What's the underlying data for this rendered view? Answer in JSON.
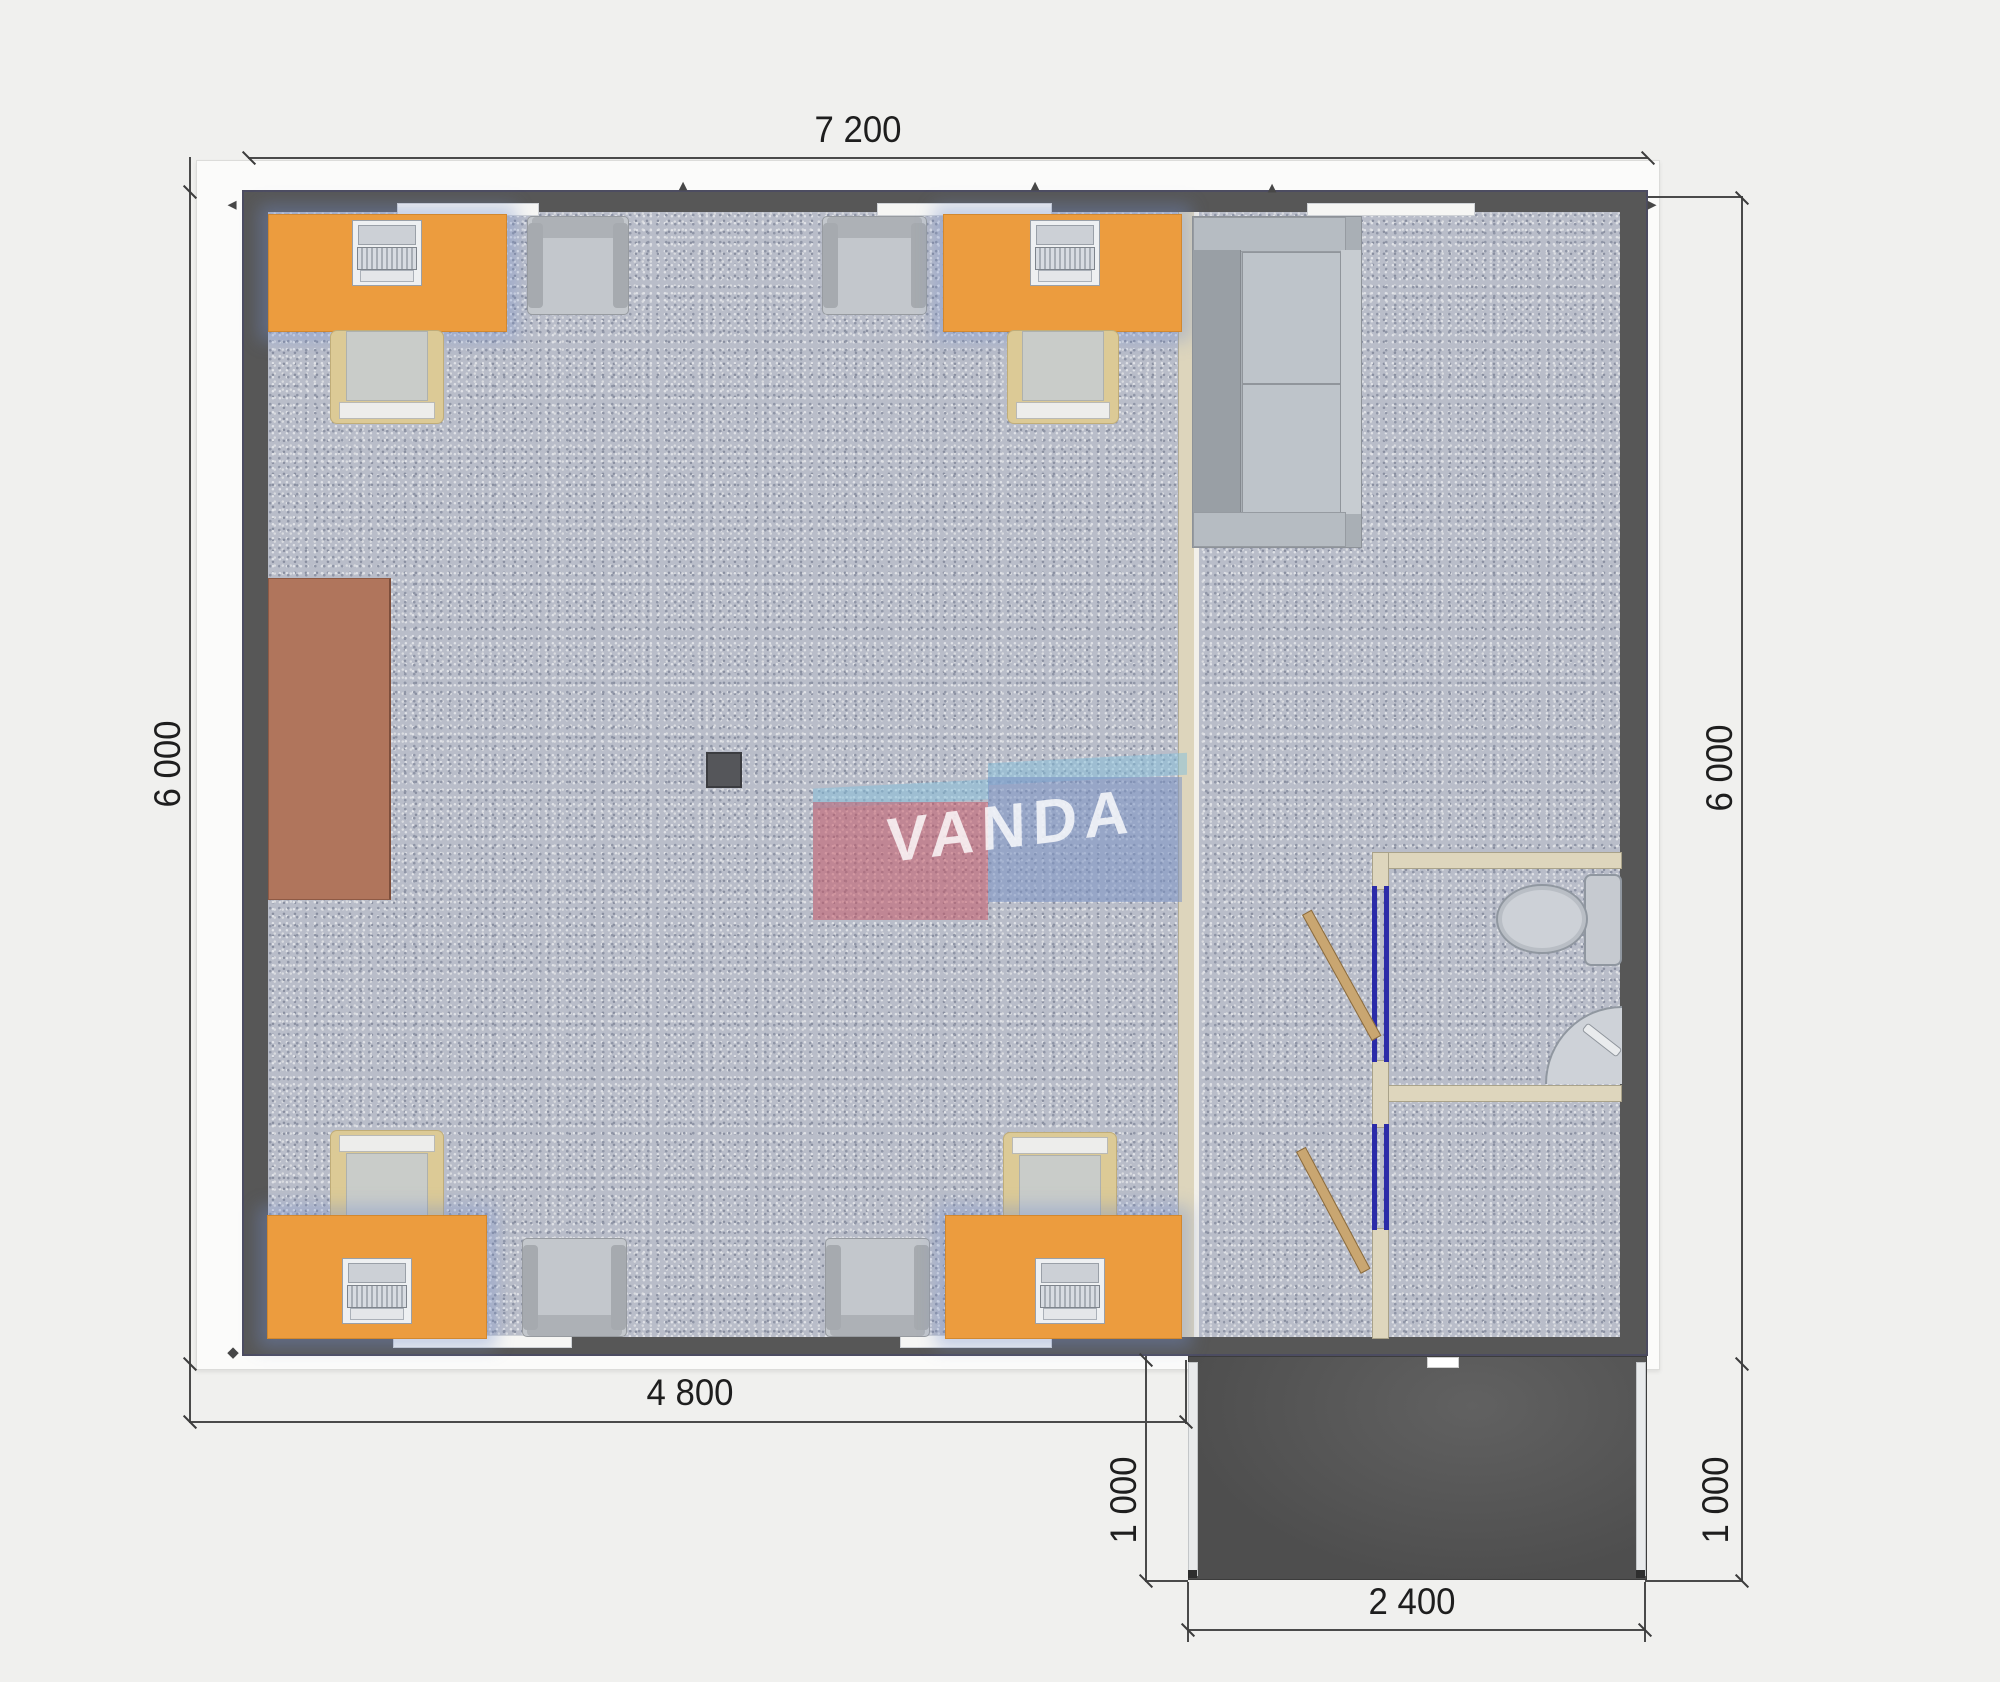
{
  "plan": {
    "watermark": "VANDA",
    "dimensions": {
      "total_width": "7 200",
      "left_height": "6 000",
      "right_height": "6 000",
      "office_width": "4 800",
      "porch_depth_left": "1 000",
      "porch_depth_right": "1 000",
      "porch_width": "2 400"
    },
    "colors": {
      "background": "#f0f0ee",
      "wall_dark": "#575757",
      "exterior_trim": "#fbfbfa",
      "carpet": "#b9bdc9",
      "desk_orange": "#ec9c3e",
      "table_brown": "#b0755c",
      "partition_cream": "#ddd5bc",
      "bath_wall_cream": "#ded6bd",
      "door_frame_blue": "#2b2ba8",
      "door_wood": "#c9a671",
      "porch_dark": "#4e4e4e",
      "furniture_gray": "#b2b6bb",
      "chair_cream": "#dcca96",
      "dimension_text": "#1e1e1e",
      "logo_red": "#c65a68",
      "logo_blue": "#7b93c4",
      "logo_light_blue": "#83c0dc"
    }
  }
}
